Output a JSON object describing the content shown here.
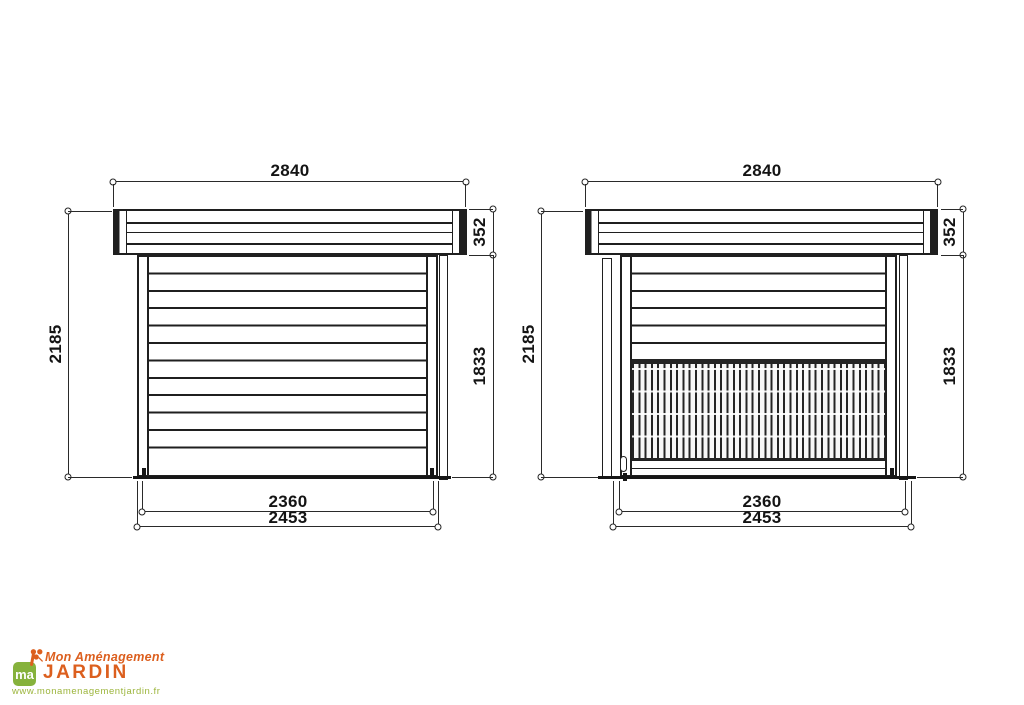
{
  "colors": {
    "line": "#1f1f1f",
    "logo_orange": "#dc5f1e",
    "logo_green": "#86b23c",
    "logo_url_green": "#9cb53c"
  },
  "views": [
    {
      "title": "front-elevation-closed",
      "dims": {
        "roof_width": "2840",
        "roof_thickness": "352",
        "overall_height": "2185",
        "wall_height": "1833",
        "inner_width": "2360",
        "outer_width": "2453"
      }
    },
    {
      "title": "front-elevation-counter",
      "dims": {
        "roof_width": "2840",
        "roof_thickness": "352",
        "overall_height": "2185",
        "wall_height": "1833",
        "inner_width": "2360",
        "outer_width": "2453"
      }
    }
  ],
  "logo": {
    "monogram": "ma",
    "line1": "Mon Aménagement",
    "line2": "JARDIN",
    "website": "www.monamenagementjardin.fr"
  }
}
